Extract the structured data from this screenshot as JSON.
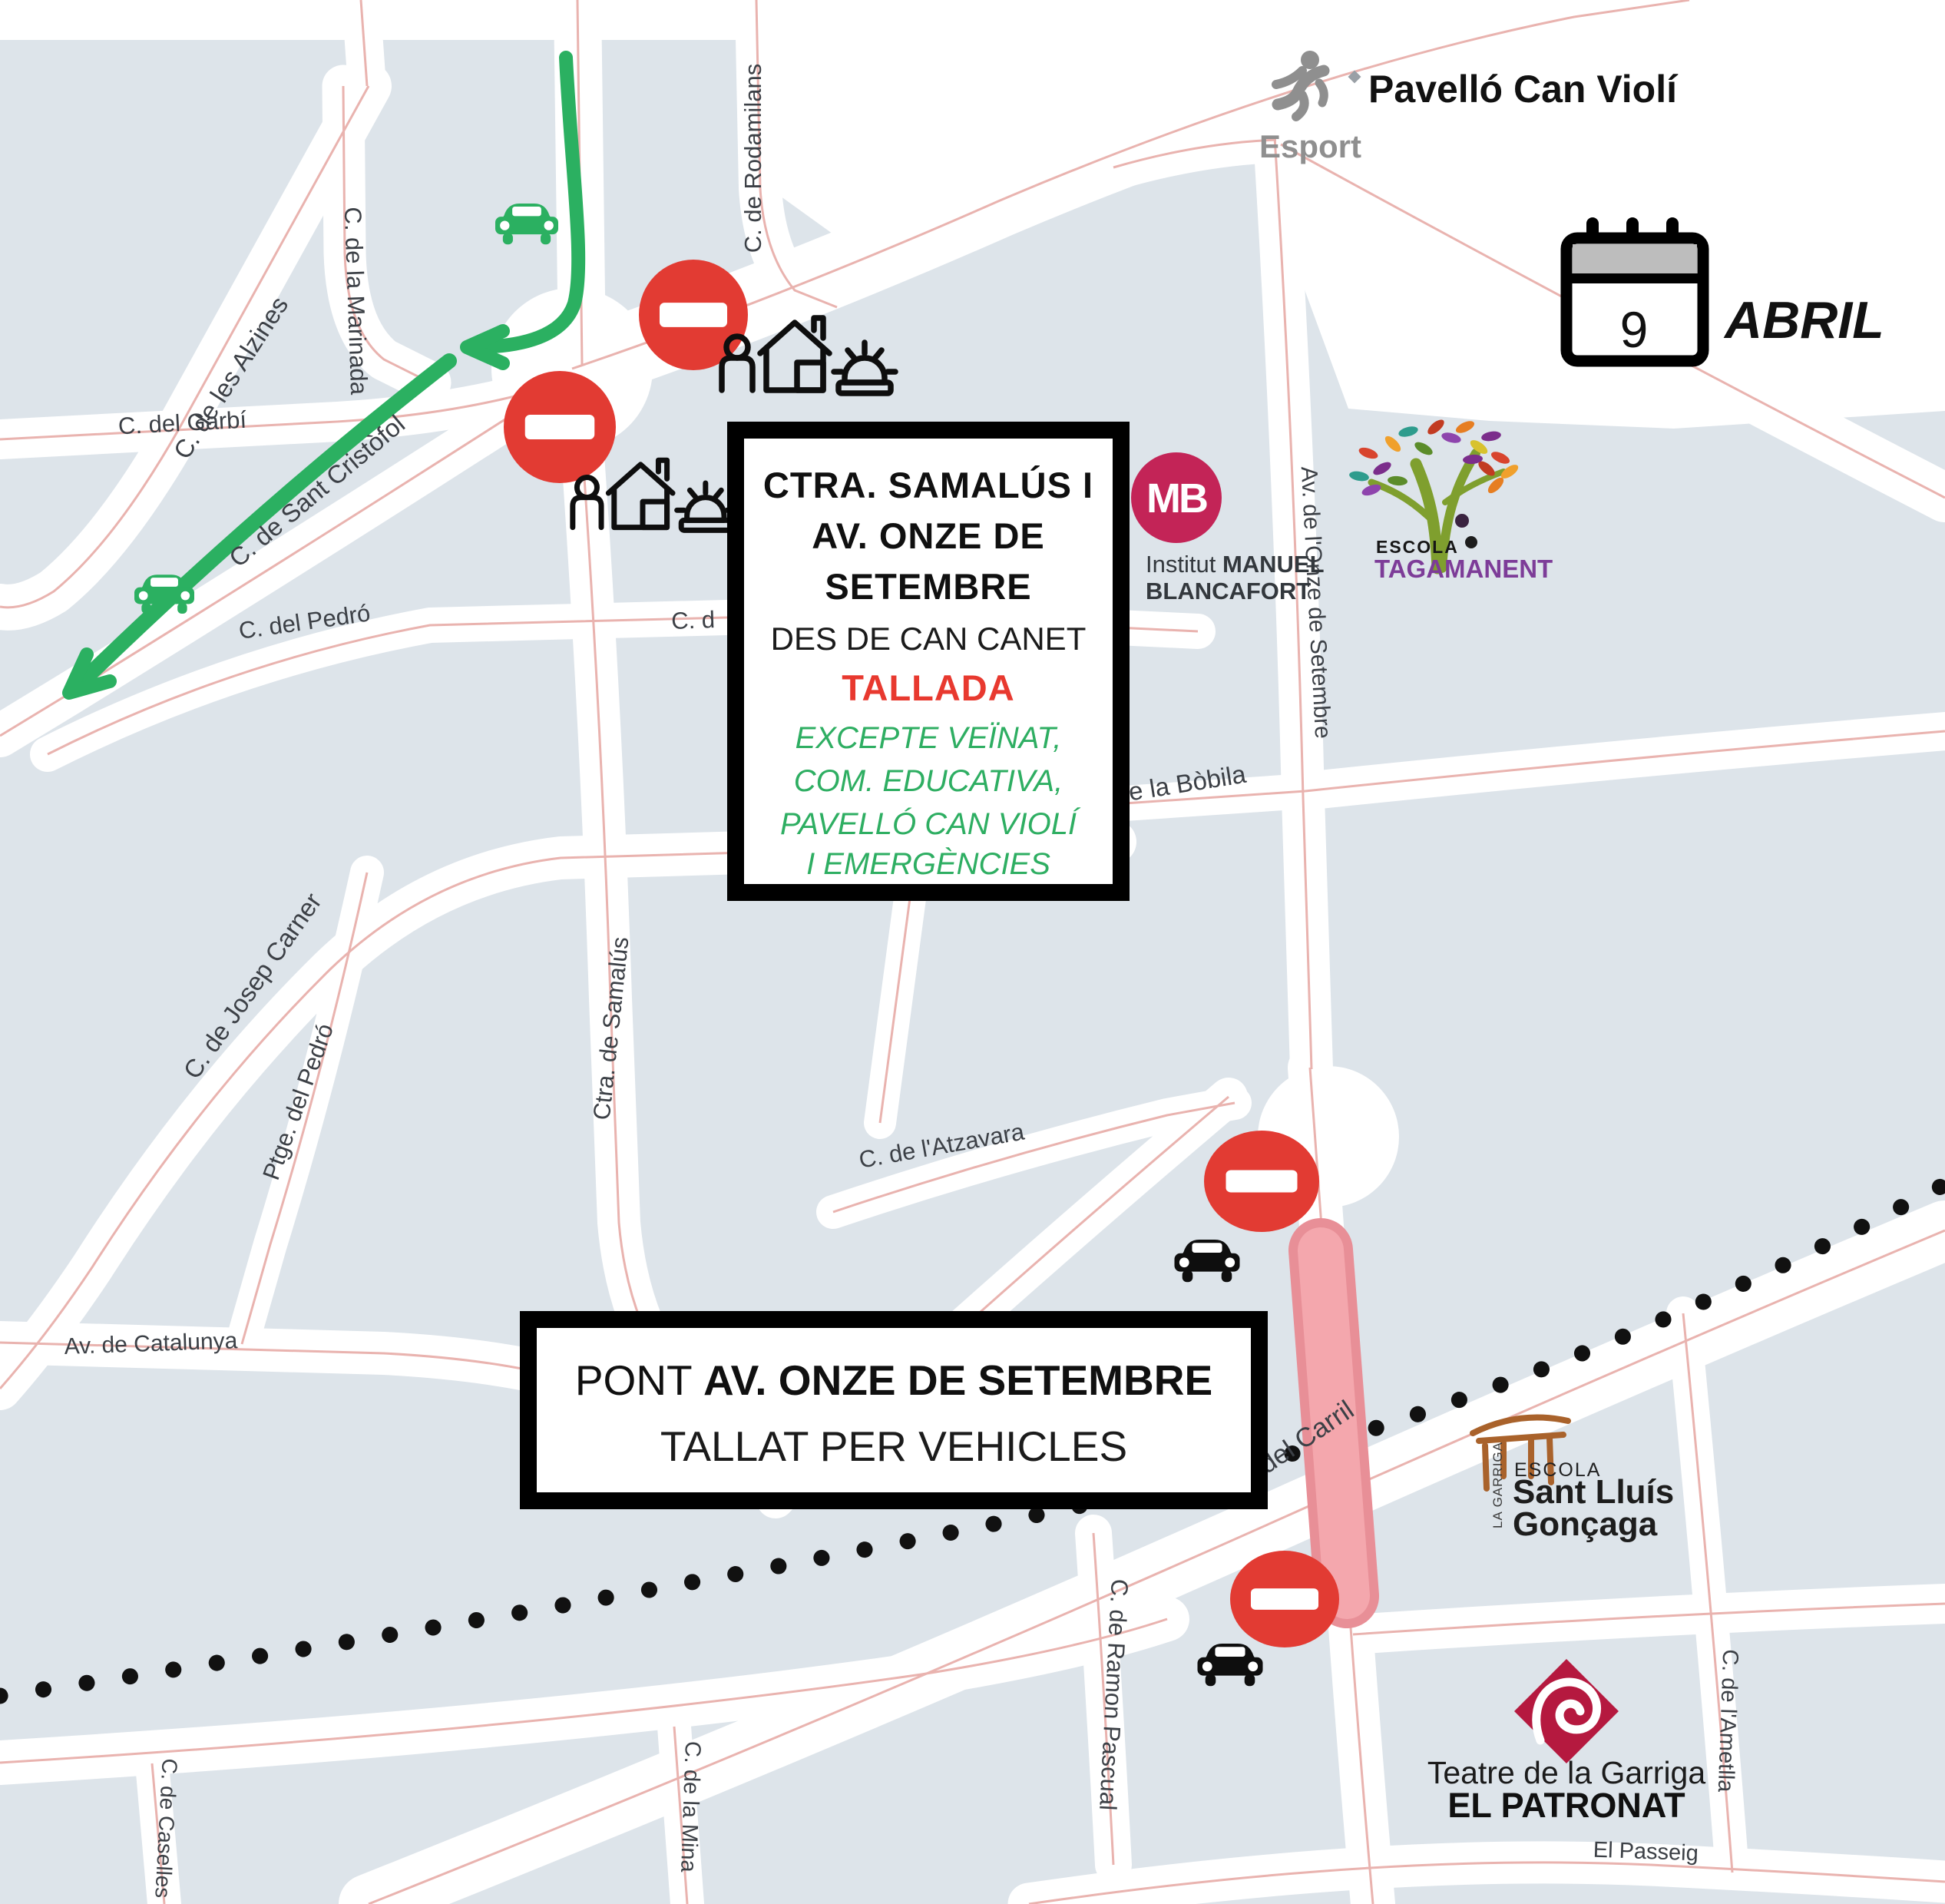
{
  "header": {
    "venue_title": "Pavelló Can Violí",
    "esport_label": "Esport"
  },
  "date_badge": {
    "day": "9",
    "month": "ABRIL"
  },
  "notices": {
    "main": {
      "title_lines": [
        "CTRA. SAMALÚS I",
        "AV. ONZE DE",
        "SETEMBRE"
      ],
      "subtitle": "DES DE CAN CANET",
      "status": "TALLADA",
      "exception_lines": [
        "EXCEPTE VEÏNAT,",
        "COM. EDUCATIVA,",
        "PAVELLÓ CAN VIOLÍ",
        "I EMERGÈNCIES"
      ]
    },
    "bridge": {
      "prefix": "PONT ",
      "road": "AV. ONZE DE SETEMBRE",
      "detail": "TALLAT PER VEHICLES"
    }
  },
  "streets": [
    "C. de les Alzines",
    "C. de la Marinada",
    "C. de Rodamilans",
    "C. del Garbí",
    "C. de Sant Cristòfol",
    "C. del Pedró",
    "C. de Josep Carner",
    "Ptge. del Pedró",
    "Ctra. de Samalús",
    "C. de l'Atzavara",
    "Av. de Catalunya",
    "Av. de l'Onze de Setembre",
    "C. de la Bòbila",
    "Rda. del Carril",
    "C. de Ramon Pascual",
    "C. de la Mina",
    "C. de Caselles",
    "C. de l'Ametlla",
    "El Passeig"
  ],
  "street_partials": {
    "pedro_east": "C. d",
    "ronda": "da"
  },
  "landmarks": {
    "institut_blancafort": {
      "monogram": "MB",
      "name_light": "Institut ",
      "name_bold": "MANUEL",
      "name_bold2": "BLANCAFORT"
    },
    "escola_tagamanent": {
      "line1": "ESCOLA",
      "line2": "TAGAMANENT"
    },
    "escola_sant_lluis": {
      "side": "LA GARRIGA",
      "line1": "ESCOLA",
      "line2": "Sant Lluís",
      "line3": "Gonçaga"
    },
    "teatre_patronat": {
      "line1": "Teatre de la Garriga",
      "line2": "EL PATRONAT"
    }
  },
  "icons": {
    "no_entry": "no-entry-sign",
    "green_car": "car-allowed-icon",
    "black_car": "car-blocked-icon",
    "house_person": "resident-access-icon",
    "siren": "emergency-icon",
    "green_route": "allowed-route-arrow",
    "calendar": "calendar-icon",
    "railway": "railway-dotted-line",
    "bridge_closed": "closed-bridge-highlight",
    "sports": "runner-icon",
    "theatre": "spiral-diamond-icon",
    "school_portico": "portico-icon",
    "tree": "colorful-tree-icon"
  },
  "colors": {
    "block": "#dde4ea",
    "street_centerline": "#e9b3af",
    "route_green": "#2bb061",
    "sign_red": "#e23b33",
    "status_red": "#e8392f",
    "exception_green": "#2eae62",
    "bridge_fill": "#f4a7ad",
    "bridge_edge": "#e88f97",
    "mb_pink": "#c32457",
    "teatre_red": "#b5193f",
    "tagamanent_purple": "#7d3c98",
    "santlluis_brown": "#a9622b",
    "esport_gray": "#8f8f8f"
  }
}
